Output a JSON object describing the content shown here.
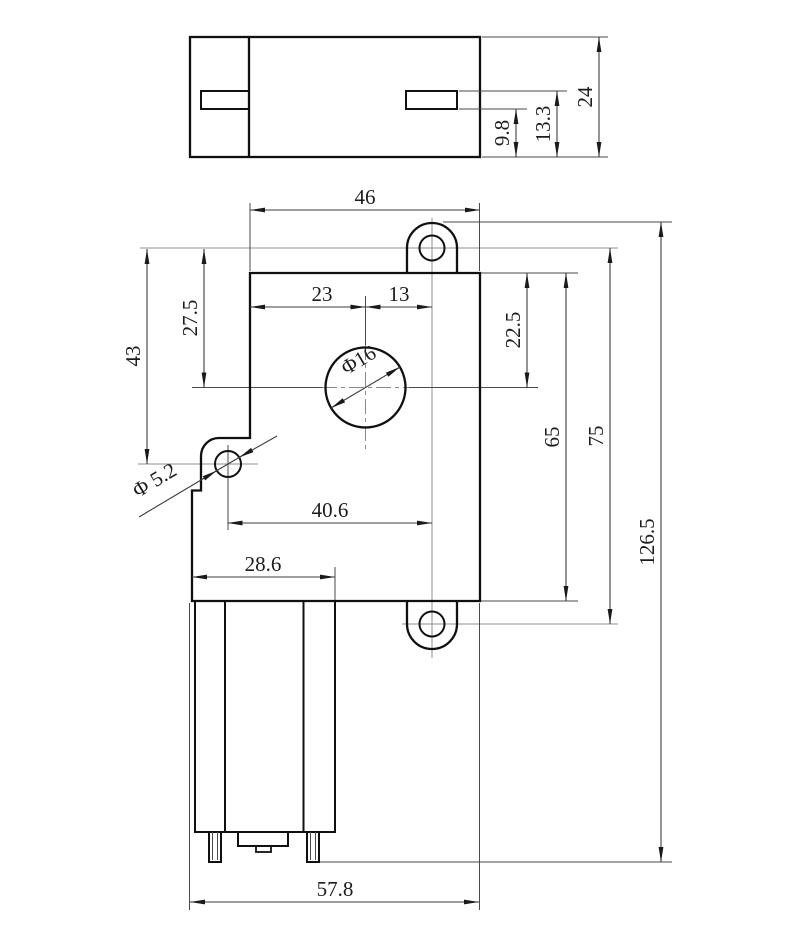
{
  "drawing": {
    "background": "#ffffff",
    "line_colors": {
      "outline": "#101010",
      "dimension": "#3d3d3d",
      "centerline": "#8f8f8f"
    },
    "top_view": {
      "overall_height": "24",
      "slot_top": "13.3",
      "slot_bottom": "9.8"
    },
    "front_view": {
      "body_width": "46",
      "shaft_offset_left": "23",
      "shaft_to_ear": "13",
      "shaft_offset_top": "27.5",
      "left_ear_offset_top": "43",
      "shaft_diameter": "Φ16",
      "ear_hole_diameter": "Φ 5.2",
      "shaft_offset_right": "22.5",
      "body_height": "65",
      "ear_center_span": "75",
      "overall_height": "126.5",
      "ear_to_ear_width": "40.6",
      "motor_width": "28.6",
      "overall_width": "57.8"
    }
  }
}
